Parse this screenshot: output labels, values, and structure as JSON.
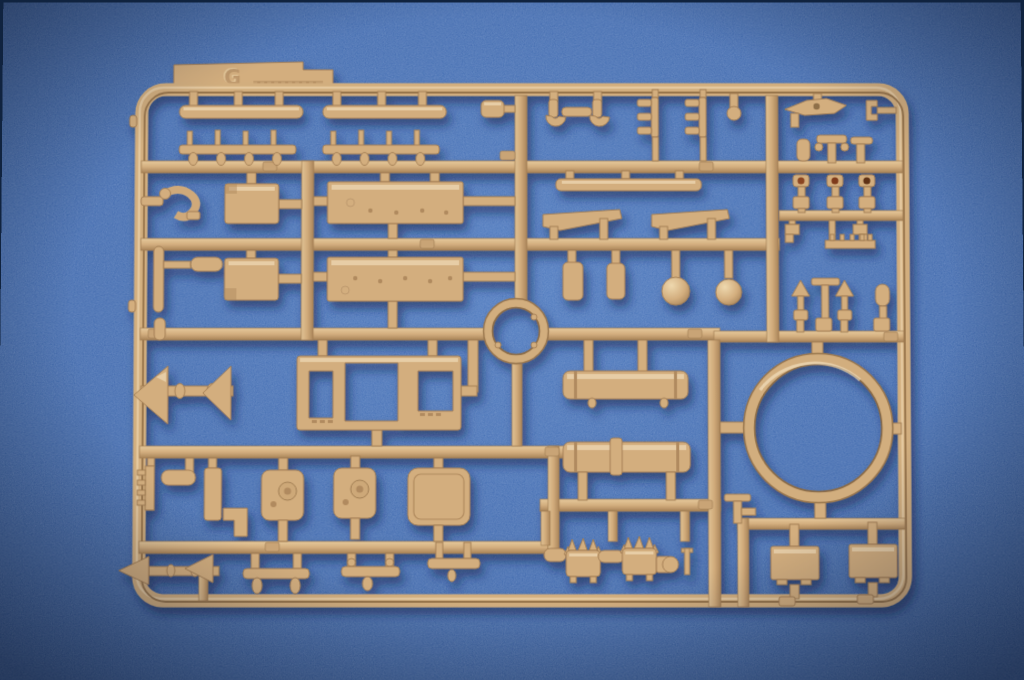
{
  "scene": {
    "type": "product photograph",
    "description": "Tan injection-molded plastic model kit sprue (parts tree) lying on a blue felt background, photographed from above with soft shadow",
    "sprue_letter": "G",
    "background_color": "#2e5ba5",
    "sprue_color": "#d3ae7e",
    "sprue_shadow_color": "#0c1f4a",
    "drilled_hole_color": "#7e3a1c",
    "parts_inventory": [
      "stepped identification tab with embossed letter",
      "flat fender strip x2",
      "toothed track-guard strip x2",
      "tow hook x2",
      "shackle bracket x2",
      "engine deck plate x2",
      "small access panel x2",
      "hull plate with three window openings",
      "large turret ring",
      "small ring collar",
      "fuel tank cylinder x2",
      "round hatch with latch x2",
      "large plain hatch",
      "winged periscope bracket",
      "drilled periscope head x3",
      "arrow-shaped bracket x4",
      "ball-headed lever x2",
      "spiky launcher drum x2",
      "stowage box plate x2",
      "comb bracket x2",
      "assorted rods, pins, clamps and brackets"
    ]
  }
}
